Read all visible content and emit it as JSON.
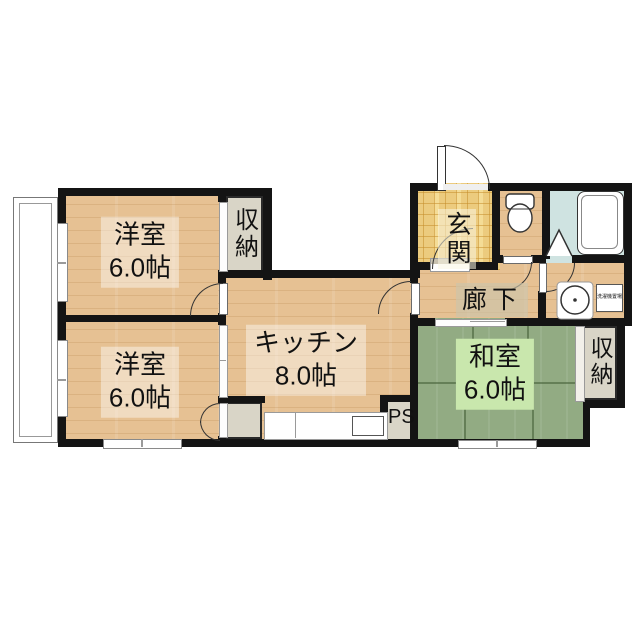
{
  "rooms": {
    "western1": {
      "name": "洋室",
      "size": "6.0帖"
    },
    "western2": {
      "name": "洋室",
      "size": "6.0帖"
    },
    "kitchen": {
      "name": "キッチン",
      "size": "8.0帖"
    },
    "japanese": {
      "name": "和室",
      "size": "6.0帖"
    },
    "entrance": {
      "name": "玄関"
    },
    "hallway": {
      "name": "廊下"
    },
    "storage_top": {
      "name": "収納"
    },
    "storage_right": {
      "name": "収納"
    },
    "pipe_space": {
      "name": "PS"
    },
    "laundry": {
      "name": "洗濯機置場"
    }
  },
  "icons": {
    "toilet": "toilet-icon",
    "bathtub": "bathtub-icon",
    "washbasin": "washbasin-icon",
    "folding_door": "folding-door-icon",
    "door_swing": "door-swing-arc",
    "window": "sliding-window",
    "balcony": "balcony"
  },
  "colors": {
    "wall": "#141414",
    "wood_floor": "#e6c193",
    "tatami": "#92ab83",
    "entrance_tile": "#eccb7e",
    "bathroom_floor": "#cfe3e1",
    "storage": "#d9d5c7",
    "tatami_label_bg": "#c9e7ad"
  }
}
